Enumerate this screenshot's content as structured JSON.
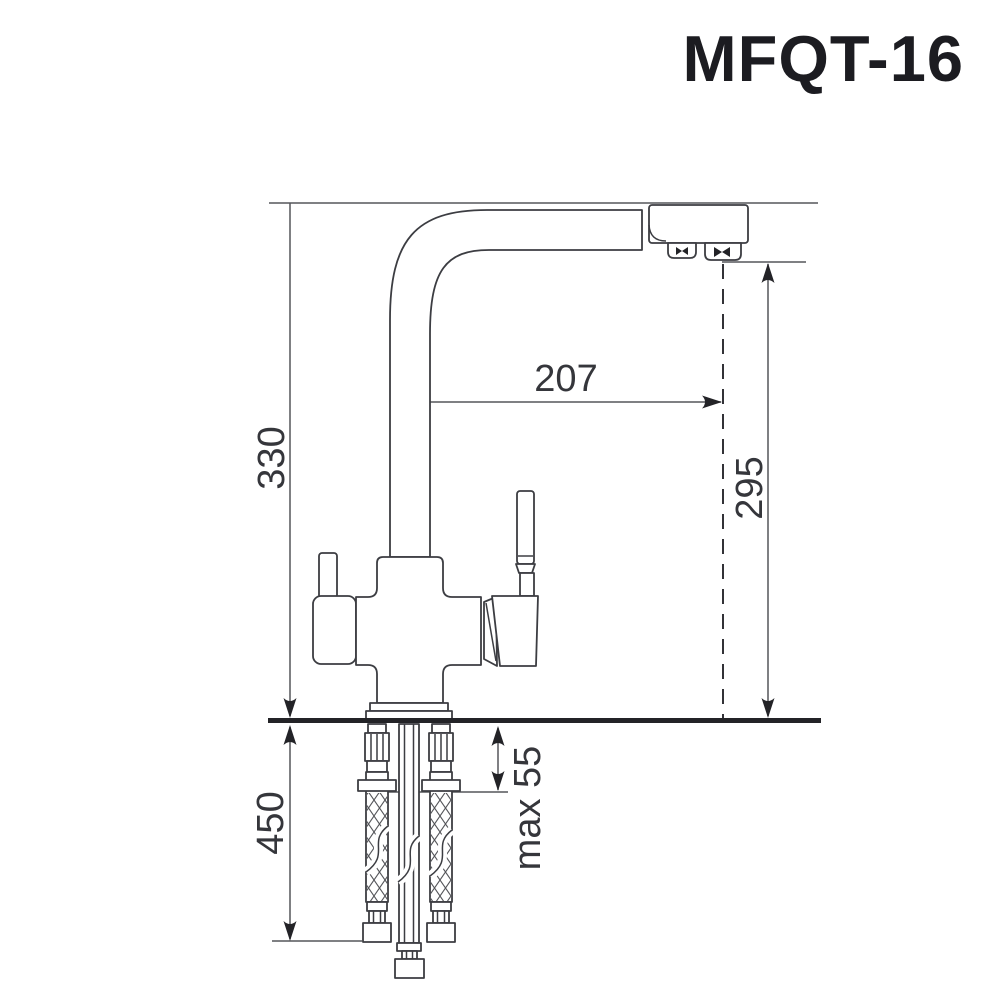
{
  "title": "MFQT-16",
  "dimensions": {
    "spout_height": "330",
    "spout_reach": "207",
    "outlet_height": "295",
    "hose_length": "450",
    "mount_thickness": "max 55"
  },
  "colors": {
    "background": "#ffffff",
    "drawing_line": "#3c3d42",
    "dimension_line": "#55565a",
    "arrowhead": "#232327",
    "label_text": "#35363b",
    "title_text": "#1c1c21"
  }
}
